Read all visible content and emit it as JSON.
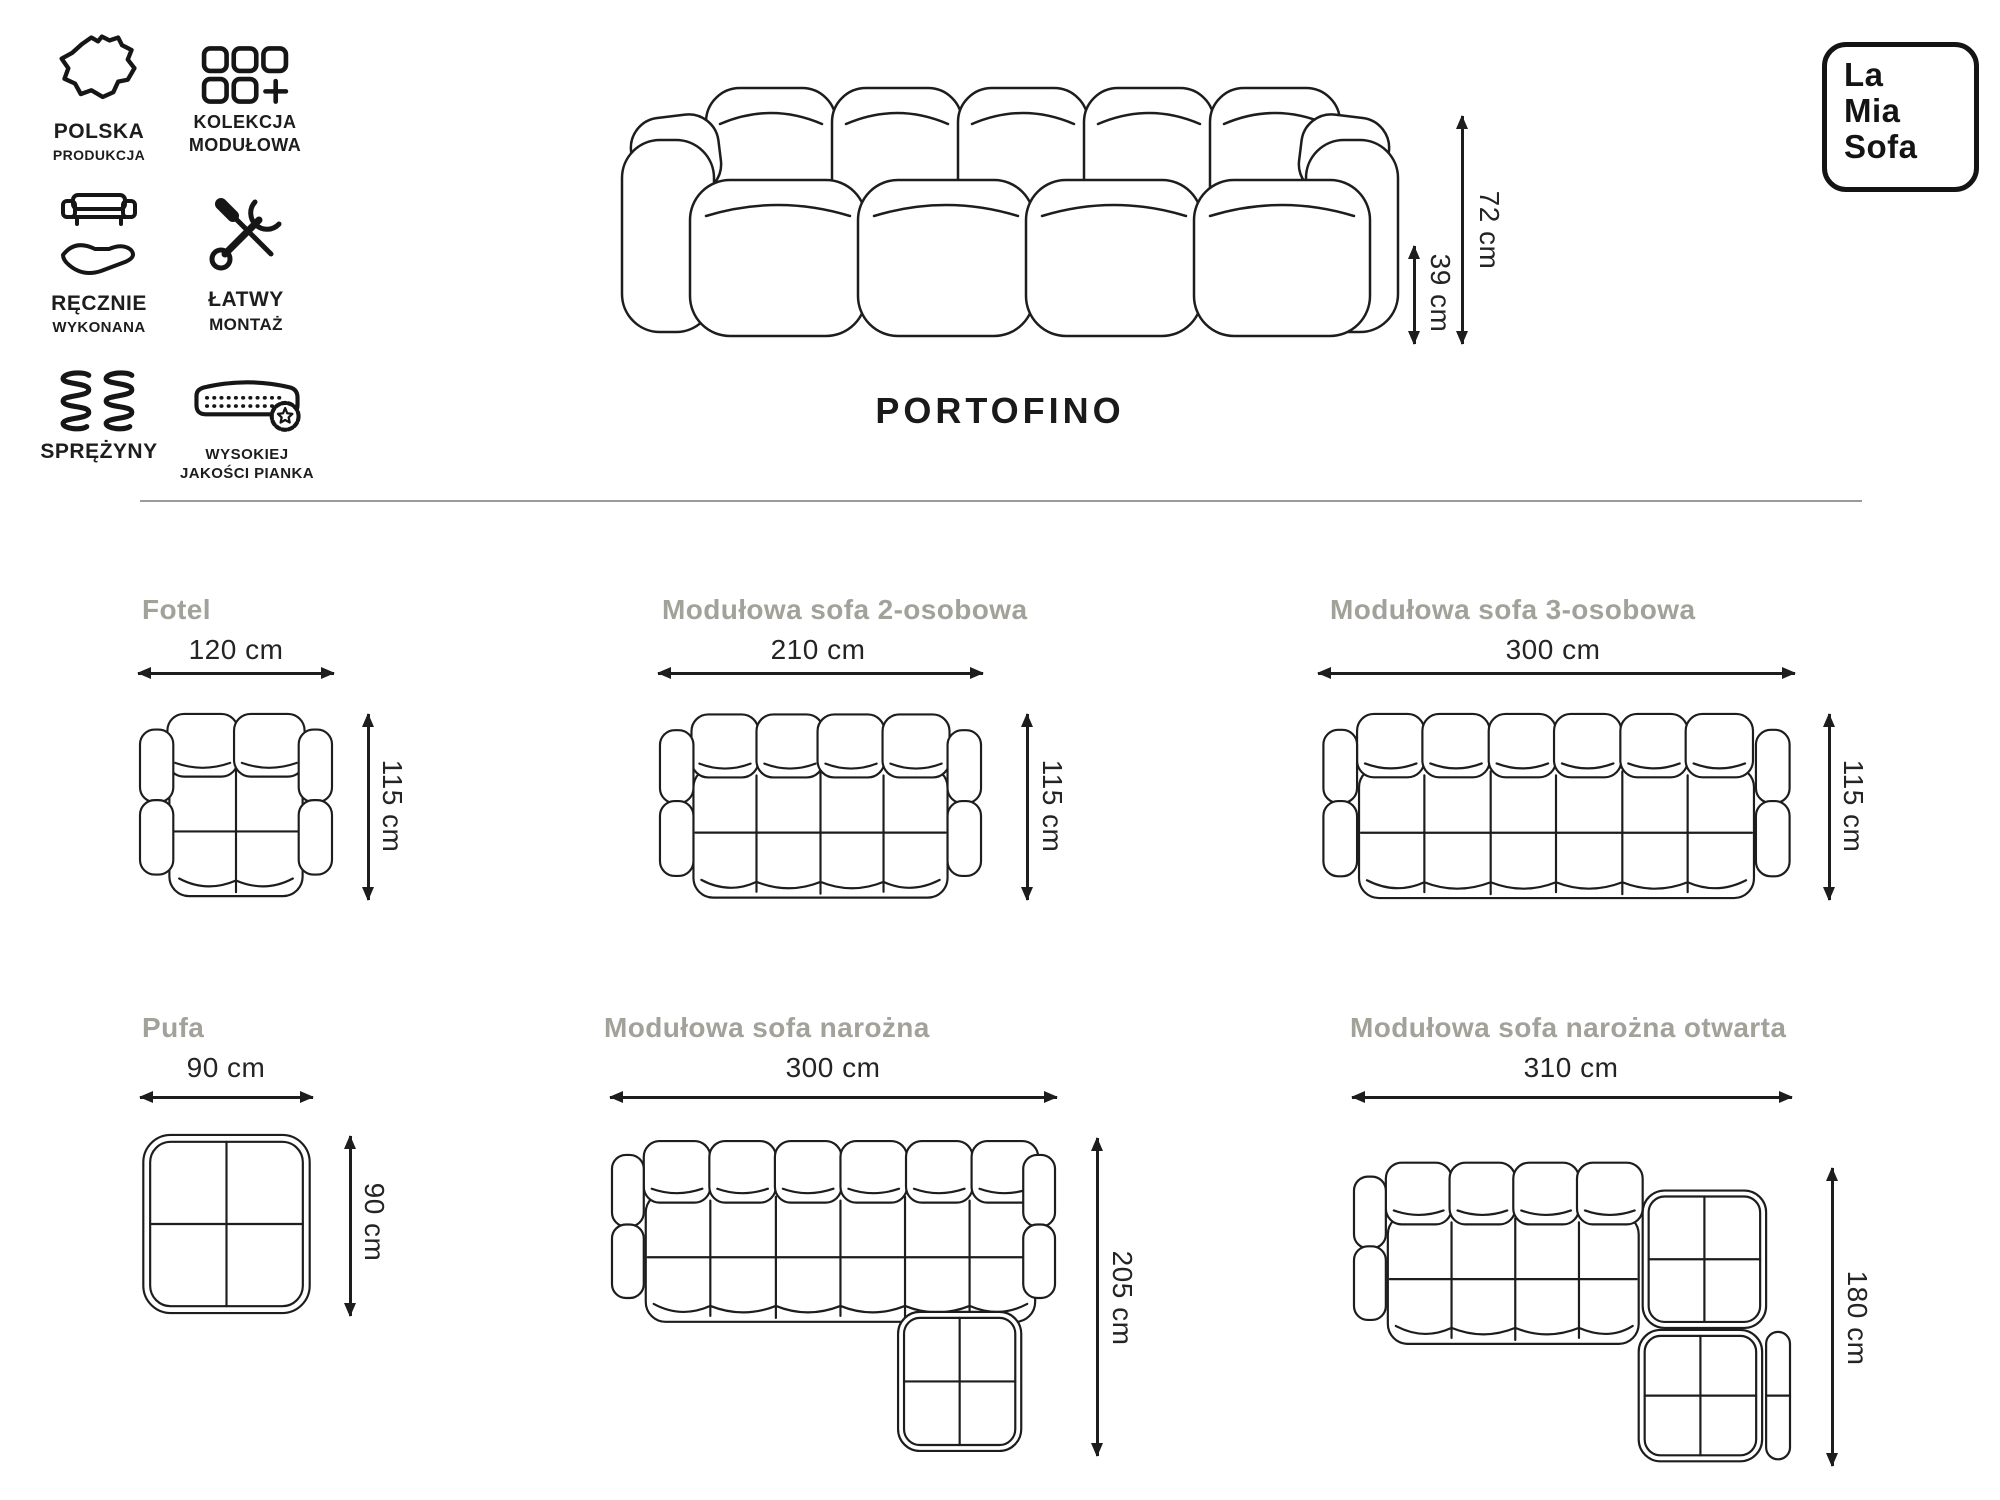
{
  "features": [
    {
      "icon": "poland-map-icon",
      "line1": "POLSKA",
      "line2": "PRODUKCJA"
    },
    {
      "icon": "modules-icon",
      "line1": "KOLEKCJA",
      "line2": "MODUŁOWA"
    },
    {
      "icon": "handmade-icon",
      "line1": "RĘCZNIE",
      "line2": "WYKONANA"
    },
    {
      "icon": "tools-icon",
      "line1": "ŁATWY",
      "line2": "MONTAŻ"
    },
    {
      "icon": "springs-icon",
      "line1": "SPRĘŻYNY",
      "line2": ""
    },
    {
      "icon": "foam-icon",
      "line1": "WYSOKIEJ",
      "line2": "JAKOŚCI PIANKA"
    }
  ],
  "hero": {
    "product_name": "PORTOFINO",
    "overall_height": "72 cm",
    "seat_height": "39 cm"
  },
  "brand": {
    "logo_lines": [
      "La",
      "Mia",
      "Sofa"
    ]
  },
  "variants": [
    {
      "name": "Fotel",
      "width": "120 cm",
      "depth": "115 cm"
    },
    {
      "name": "Modułowa sofa 2-osobowa",
      "width": "210 cm",
      "depth": "115 cm"
    },
    {
      "name": "Modułowa sofa 3-osobowa",
      "width": "300 cm",
      "depth": "115 cm"
    },
    {
      "name": "Pufa",
      "width": "90 cm",
      "depth": "90 cm"
    },
    {
      "name": "Modułowa sofa narożna",
      "width": "300 cm",
      "depth": "205 cm"
    },
    {
      "name": "Modułowa sofa narożna otwarta",
      "width": "310 cm",
      "depth": "180 cm"
    }
  ],
  "colors": {
    "ink": "#1d1d1d",
    "muted_title": "#a2a29a",
    "divider": "#9b9b97",
    "background": "#ffffff"
  }
}
